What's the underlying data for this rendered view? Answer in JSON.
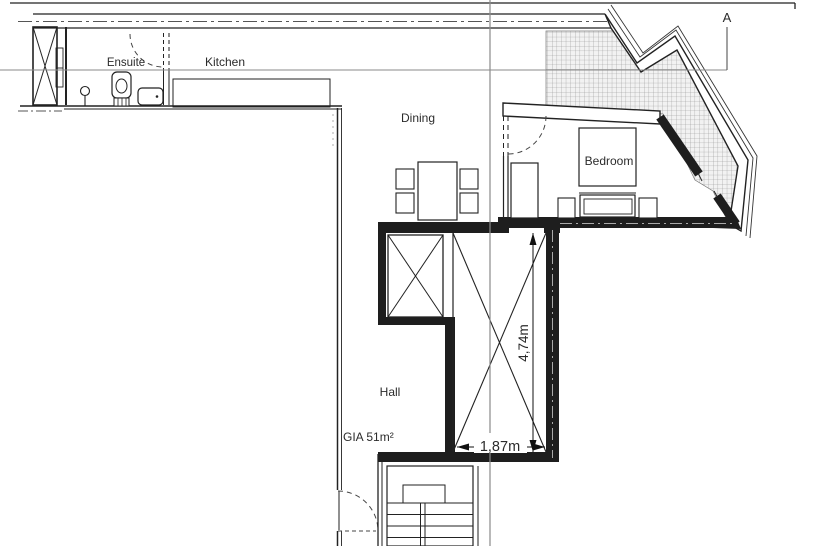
{
  "drawing_type": "architectural-floor-plan",
  "labels": {
    "ensuite": "Ensuite",
    "kitchen": "Kitchen",
    "dining": "Dining",
    "bedroom": "Bedroom",
    "hall": "Hall",
    "gia": "GIA 51m²"
  },
  "dimensions": {
    "vertical": "4,74m",
    "horizontal": "1,87m"
  },
  "section": {
    "marker": "A"
  },
  "fixtures": [
    "lift-shaft-cross-box",
    "toilet",
    "wash-basin",
    "pedestal",
    "kitchen-counter",
    "dining-table",
    "dining-chairs",
    "bed",
    "wardrobe",
    "bedside-tables",
    "void-cross-boxes",
    "staircase",
    "terrace-hatch",
    "door-swings"
  ],
  "colors": {
    "line": "#222222",
    "wall_fill": "#1e1e1e",
    "section_line": "#8a8a8a",
    "hatch_line": "#909090",
    "text": "#2b2b2b"
  }
}
